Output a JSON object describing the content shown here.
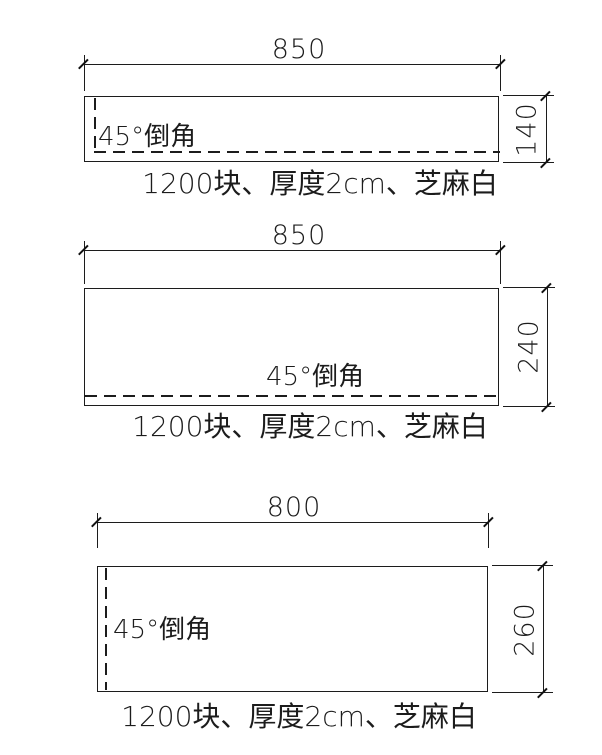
{
  "drawing": {
    "panels": [
      {
        "width_dim": "850",
        "height_dim": "140",
        "chamfer_note": "45°倒角",
        "caption": "1200块、厚度2cm、芝麻白"
      },
      {
        "width_dim": "850",
        "height_dim": "240",
        "chamfer_note": "45°倒角",
        "caption": "1200块、厚度2cm、芝麻白"
      },
      {
        "width_dim": "800",
        "height_dim": "260",
        "chamfer_note": "45°倒角",
        "caption": "1200块、厚度2cm、芝麻白"
      }
    ],
    "colors": {
      "line": "#1c1c1c",
      "background": "#ffffff"
    }
  }
}
